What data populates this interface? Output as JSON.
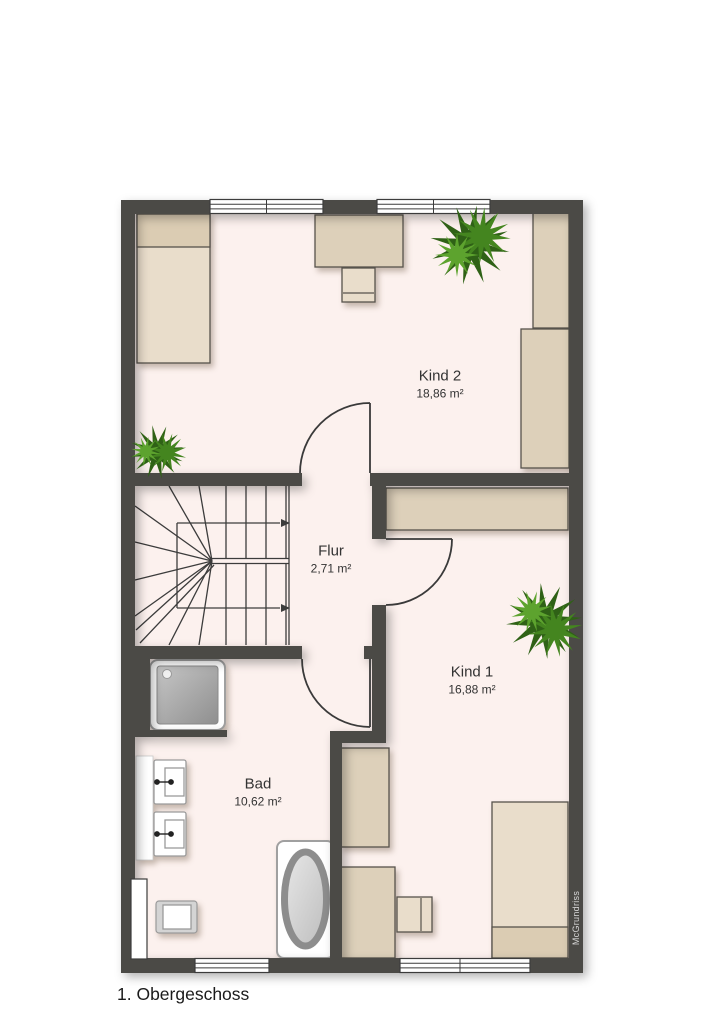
{
  "title": "1. Obergeschoss",
  "watermark": "McGrundriss",
  "rooms": [
    {
      "id": "kind2",
      "name": "Kind 2",
      "area": "18,86 m²"
    },
    {
      "id": "flur",
      "name": "Flur",
      "area": "2,71 m²"
    },
    {
      "id": "kind1",
      "name": "Kind 1",
      "area": "16,88 m²"
    },
    {
      "id": "bad",
      "name": "Bad",
      "area": "10,62 m²"
    }
  ],
  "colors": {
    "wall": "#4b4a46",
    "floor": "#fcf1ee",
    "furnA": "#e9ddcb",
    "furnB": "#ddd0ba",
    "pillow": "#dbccb3",
    "border": "#57534c",
    "line": "#3c3c3c",
    "text": "#333333",
    "watermark": "#d6d6d6",
    "plantDark": "#2f6116",
    "plantMid": "#44851f",
    "plantLight": "#5da32e"
  }
}
